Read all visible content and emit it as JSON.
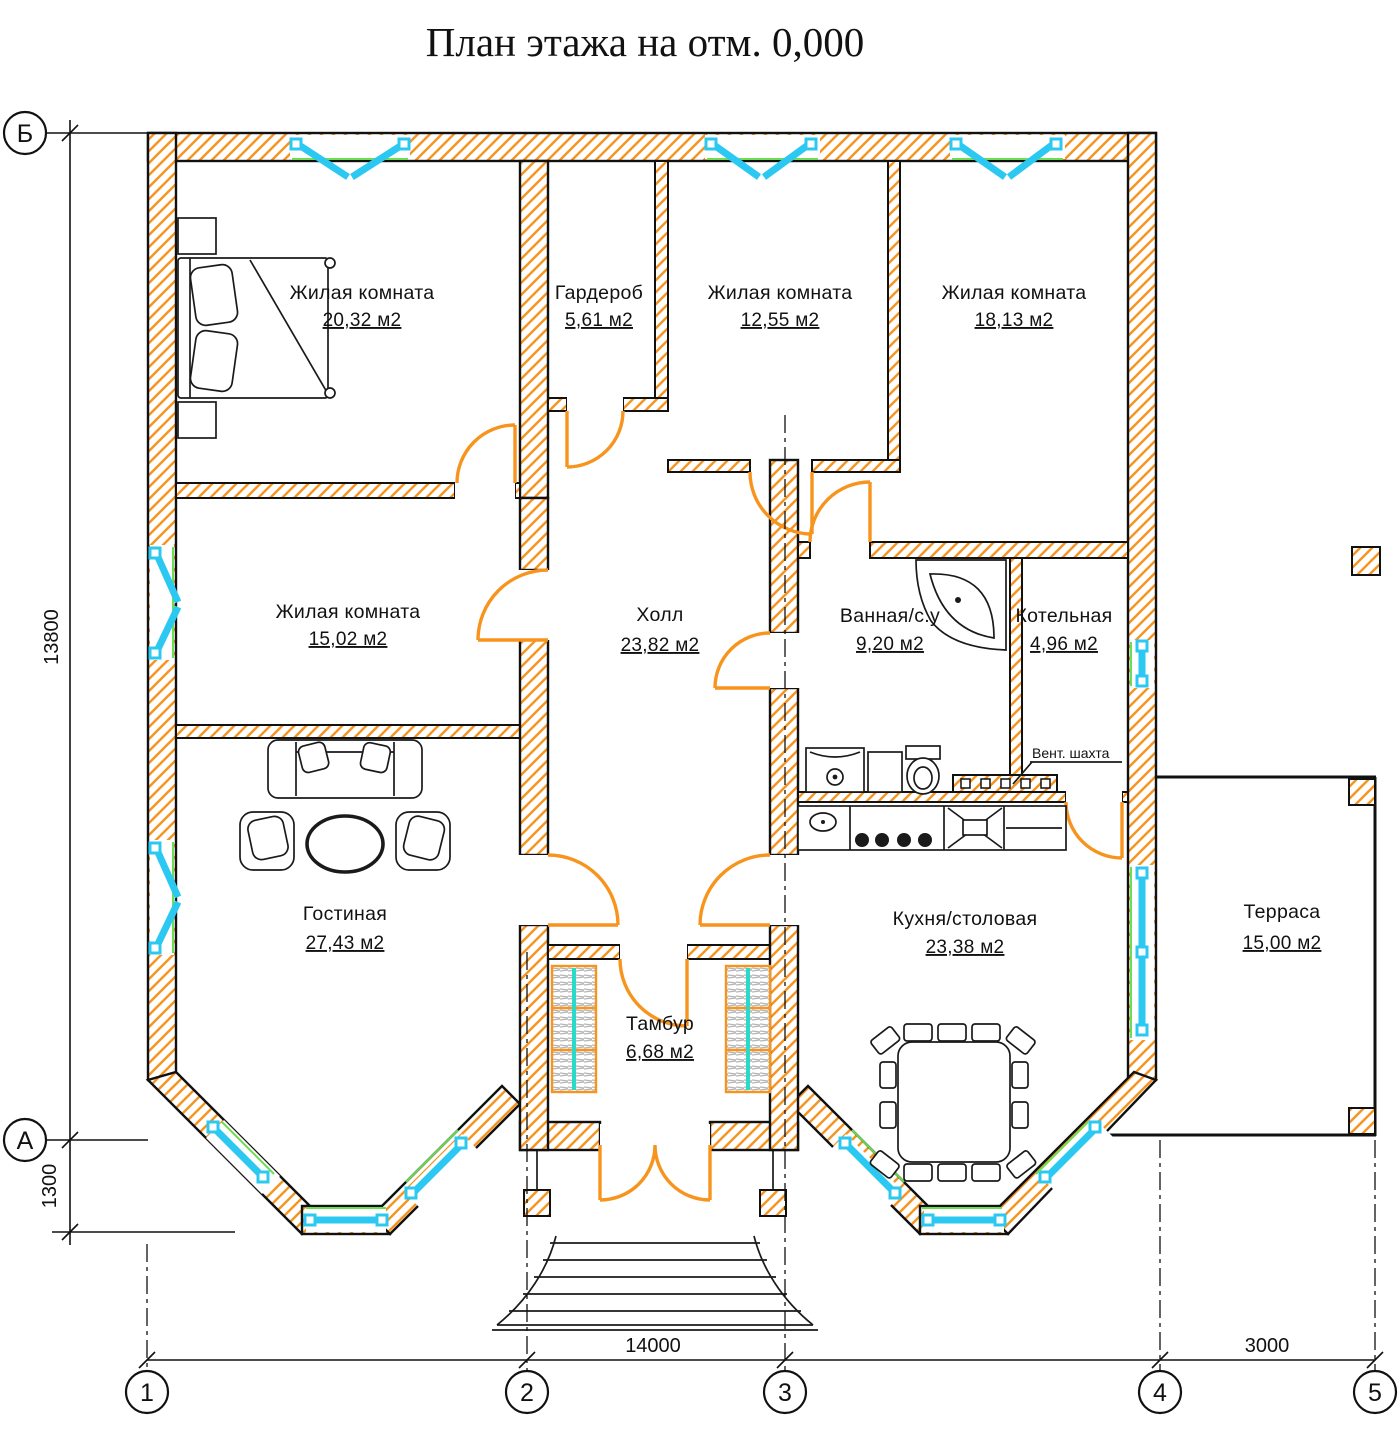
{
  "title": "План этажа на отм. 0,000",
  "rooms": [
    {
      "name": "Жилая комната",
      "area": "20,32 м2"
    },
    {
      "name": "Гардероб",
      "area": "5,61 м2"
    },
    {
      "name": "Жилая комната",
      "area": "12,55 м2"
    },
    {
      "name": "Жилая комната",
      "area": "18,13 м2"
    },
    {
      "name": "Жилая комната",
      "area": "15,02 м2"
    },
    {
      "name": "Холл",
      "area": "23,82 м2"
    },
    {
      "name": "Ванная/с.у",
      "area": "9,20 м2"
    },
    {
      "name": "Котельная",
      "area": "4,96 м2"
    },
    {
      "name": "Гостиная",
      "area": "27,43 м2"
    },
    {
      "name": "Кухня/столовая",
      "area": "23,38 м2"
    },
    {
      "name": "Тамбур",
      "area": "6,68 м2"
    },
    {
      "name": "Терраса",
      "area": "15,00 м2"
    }
  ],
  "annotations": {
    "vent_shaft": "Вент. шахта"
  },
  "dimensions": {
    "height_total": "13800",
    "porch_offset": "1300",
    "width_main": "14000",
    "width_terrace": "3000"
  },
  "axes": {
    "horizontal": [
      "Б",
      "А"
    ],
    "vertical": [
      "1",
      "2",
      "3",
      "4",
      "5"
    ]
  },
  "colors": {
    "wall_hatch": "#F7941E",
    "door": "#F7941E",
    "window": "#2BC8F2",
    "glass": "#6CDE51",
    "wardrobe_accent": "#2BD9C8",
    "ink": "#111111"
  }
}
